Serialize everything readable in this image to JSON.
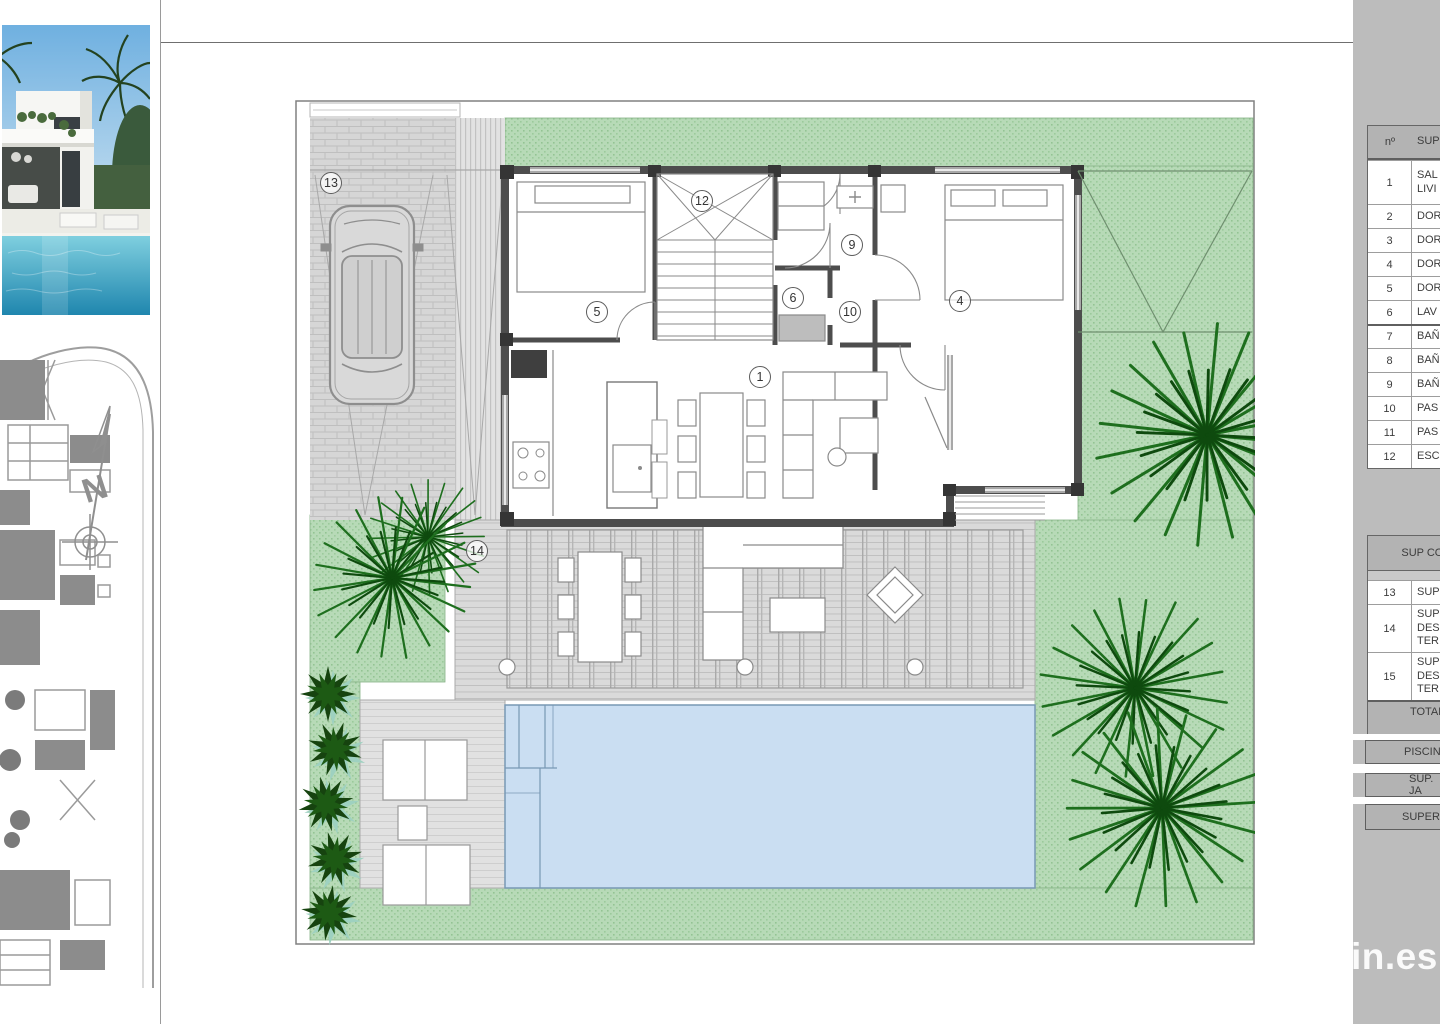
{
  "plan": {
    "labels": [
      "1",
      "4",
      "5",
      "6",
      "9",
      "10",
      "12",
      "13",
      "14"
    ]
  },
  "compass": {
    "north": "N"
  },
  "table": {
    "header": {
      "num": "nº",
      "desc": "SUP"
    },
    "rooms": [
      {
        "num": "1",
        "desc": "SAL\nLIVI"
      },
      {
        "num": "2",
        "desc": "DOR"
      },
      {
        "num": "3",
        "desc": "DOR"
      },
      {
        "num": "4",
        "desc": "DOR"
      },
      {
        "num": "5",
        "desc": "DOR"
      },
      {
        "num": "6",
        "desc": "LAV"
      },
      {
        "num": "7",
        "desc": "BAÑ"
      },
      {
        "num": "8",
        "desc": "BAÑ"
      },
      {
        "num": "9",
        "desc": "BAÑ"
      },
      {
        "num": "10",
        "desc": "PAS"
      },
      {
        "num": "11",
        "desc": "PAS"
      },
      {
        "num": "12",
        "desc": "ESC"
      }
    ],
    "section2": {
      "header": "SUP CONS",
      "rows": [
        {
          "num": "13",
          "desc": "SUP"
        },
        {
          "num": "14",
          "desc": "SUP\nDES\nTER"
        },
        {
          "num": "15",
          "desc": "SUP\nDES\nTER"
        }
      ],
      "total": "TOTAL SUP CO\nBU"
    },
    "footer": {
      "pool": "PISCIN",
      "garden": "SUP. JA",
      "surface": "SUPERFIC"
    }
  },
  "watermark": "in.es",
  "colors": {
    "grass": "#b7dab7",
    "pool": "#cadef2",
    "wall": "#4d4d4d",
    "palm": "#1d6b1d",
    "panel": "#bcbcbc",
    "deck": "#dadada"
  }
}
